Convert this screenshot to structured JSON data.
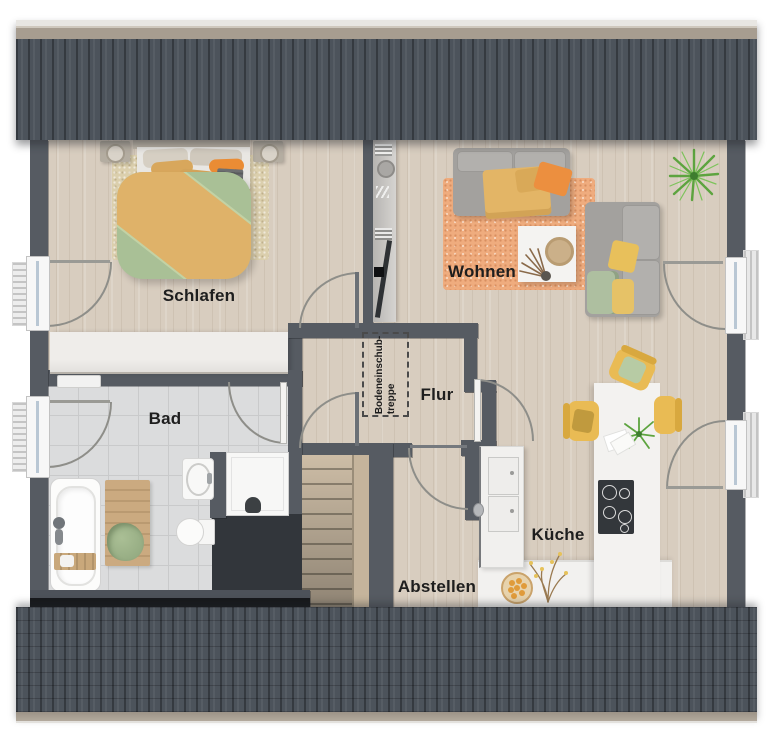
{
  "plan": {
    "floor_type": "attic-floorplan",
    "rooms": {
      "schlafen": {
        "label": "Schlafen"
      },
      "wohnen": {
        "label": "Wohnen"
      },
      "bad": {
        "label": "Bad"
      },
      "flur": {
        "label": "Flur"
      },
      "kueche": {
        "label": "Küche"
      },
      "abstellen": {
        "label": "Abstellen"
      },
      "attic_hatch": {
        "label_line1": "Bodeneinschub-",
        "label_line2": "treppe"
      }
    },
    "furniture": [
      "double-bed",
      "wardrobe",
      "tv-sideboard",
      "sofa",
      "chaise-sofa",
      "coffee-table",
      "area-rug",
      "potted-palm",
      "dining-table",
      "dining-chairs",
      "kitchen-island",
      "cooktop",
      "tall-cabinet",
      "kitchen-counter",
      "fruit-bowl",
      "bathtub",
      "bath-mat",
      "washbasin",
      "toilet",
      "shower",
      "staircase",
      "loft-ladder-hatch",
      "windows",
      "radiators"
    ],
    "colors": {
      "roof": "#4c535b",
      "ridge_wood": "#a79d90",
      "wall": "#565b62",
      "wood_floor": "#d8cdbf",
      "tile_floor": "#dbdcdd",
      "rug_orange": "#efac7e",
      "rug_beige": "#dbcfad",
      "duvet_green": "#a9c096",
      "blanket_yellow": "#dfb269",
      "accent_orange": "#ea8c34",
      "sofa_gray": "#a3a19e",
      "kitchen_white": "#f2f1ef",
      "stairs_wood": "#cdbda6",
      "chair_yellow": "#e9bb54",
      "plant_green": "#5da43f",
      "bath_mat_wood": "#c9a87e"
    }
  }
}
